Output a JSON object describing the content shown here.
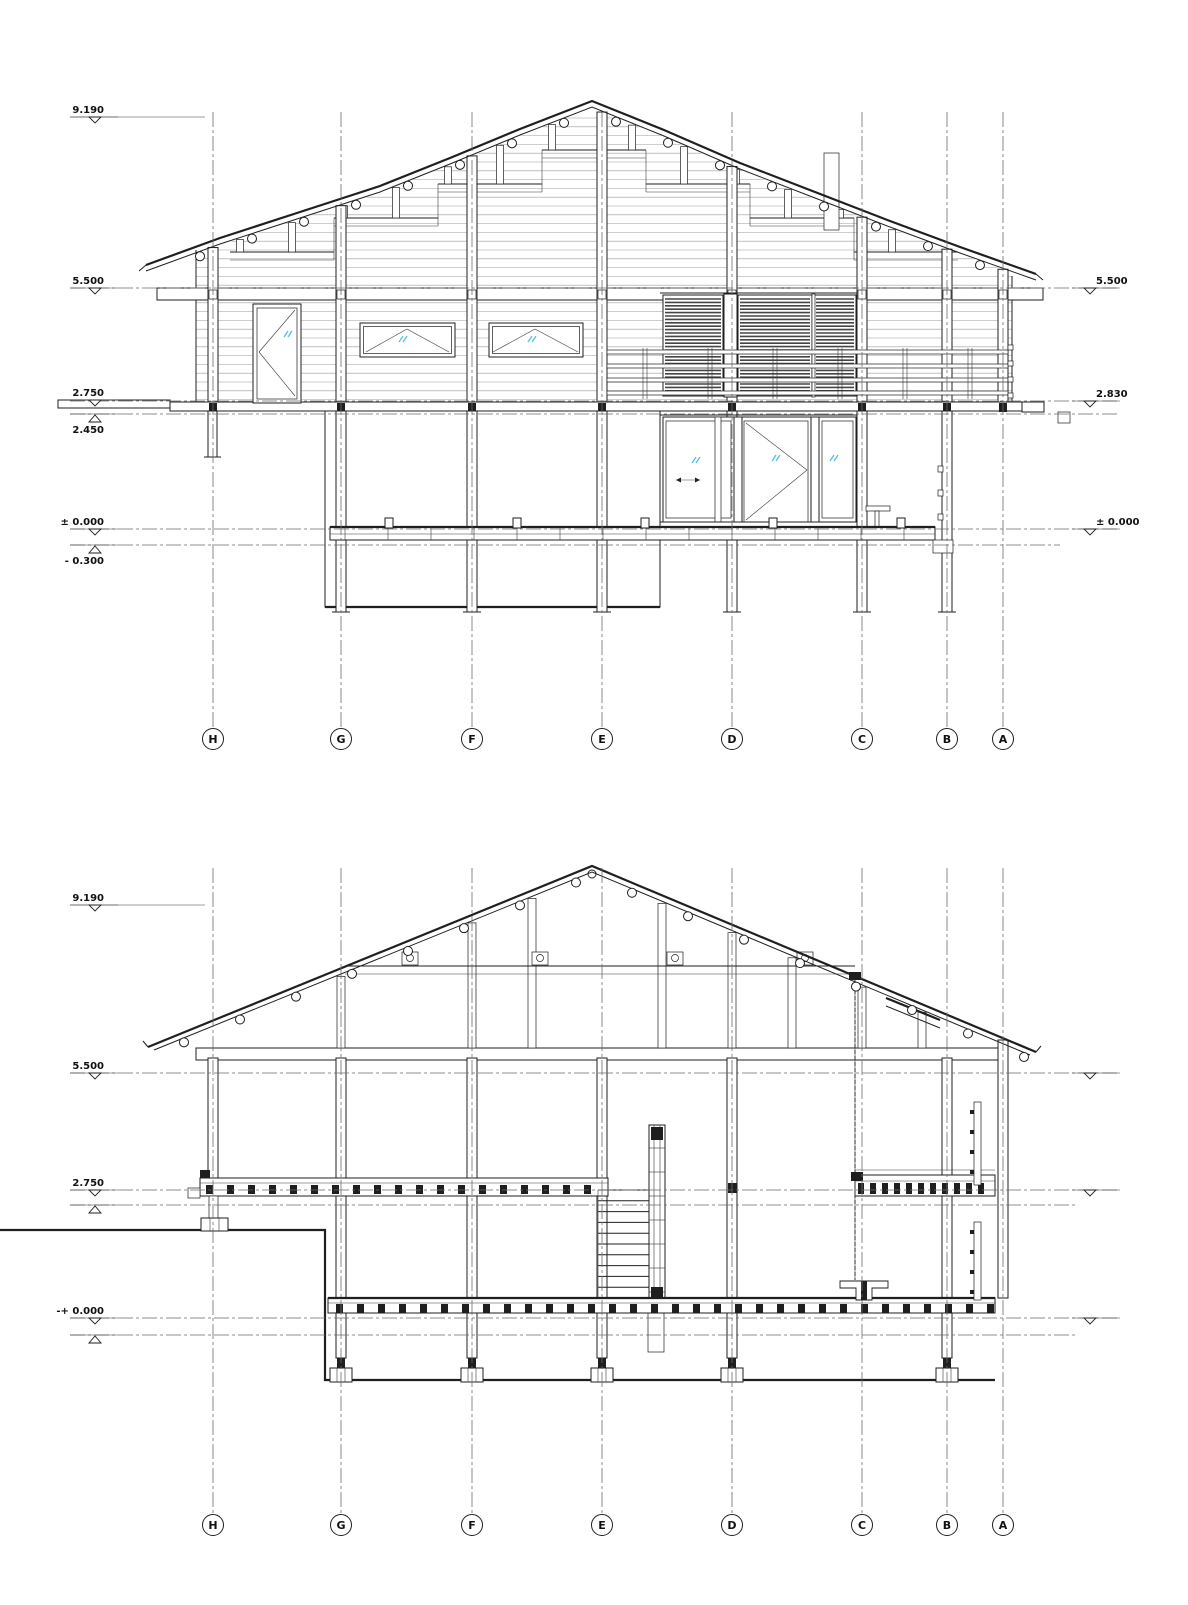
{
  "sheet": {
    "background": "#ffffff",
    "line_color": "#1f1f1f",
    "glass_color": "#49bfdd"
  },
  "grid": {
    "letters": [
      "H",
      "G",
      "F",
      "E",
      "D",
      "C",
      "B",
      "A"
    ]
  },
  "levels": {
    "v9190": "9.190",
    "v5500": "5.500",
    "v2750": "2.750",
    "v2450": "2.450",
    "v0000": "± 0.000",
    "vm0300": "- 0.300",
    "v2830": "2.830",
    "vpm0000": "-+ 0.000"
  },
  "views": [
    {
      "name": "side-elevation"
    },
    {
      "name": "cross-section"
    }
  ]
}
